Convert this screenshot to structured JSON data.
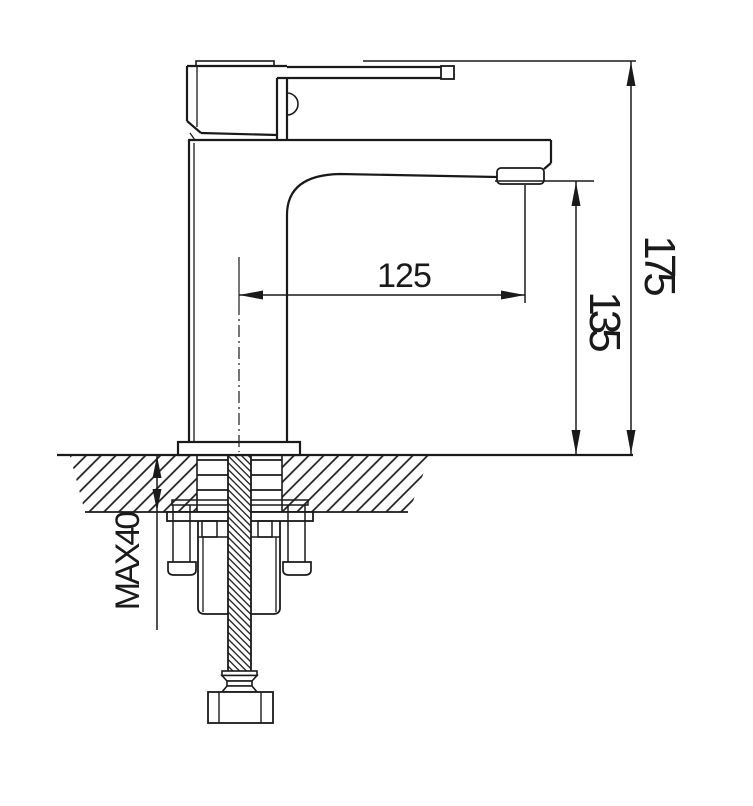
{
  "page": {
    "background": "#ffffff",
    "line_color": "#1a1a1a"
  },
  "drawing": {
    "type": "technical-installation-diagram",
    "subject": "single-lever basin mixer faucet side elevation with countertop cross-section",
    "dimensions": {
      "spout_reach": {
        "label": "125"
      },
      "spout_height": {
        "label": "135"
      },
      "total_height": {
        "label": "175"
      },
      "counter_thickness": {
        "label": "MAX40"
      }
    }
  }
}
